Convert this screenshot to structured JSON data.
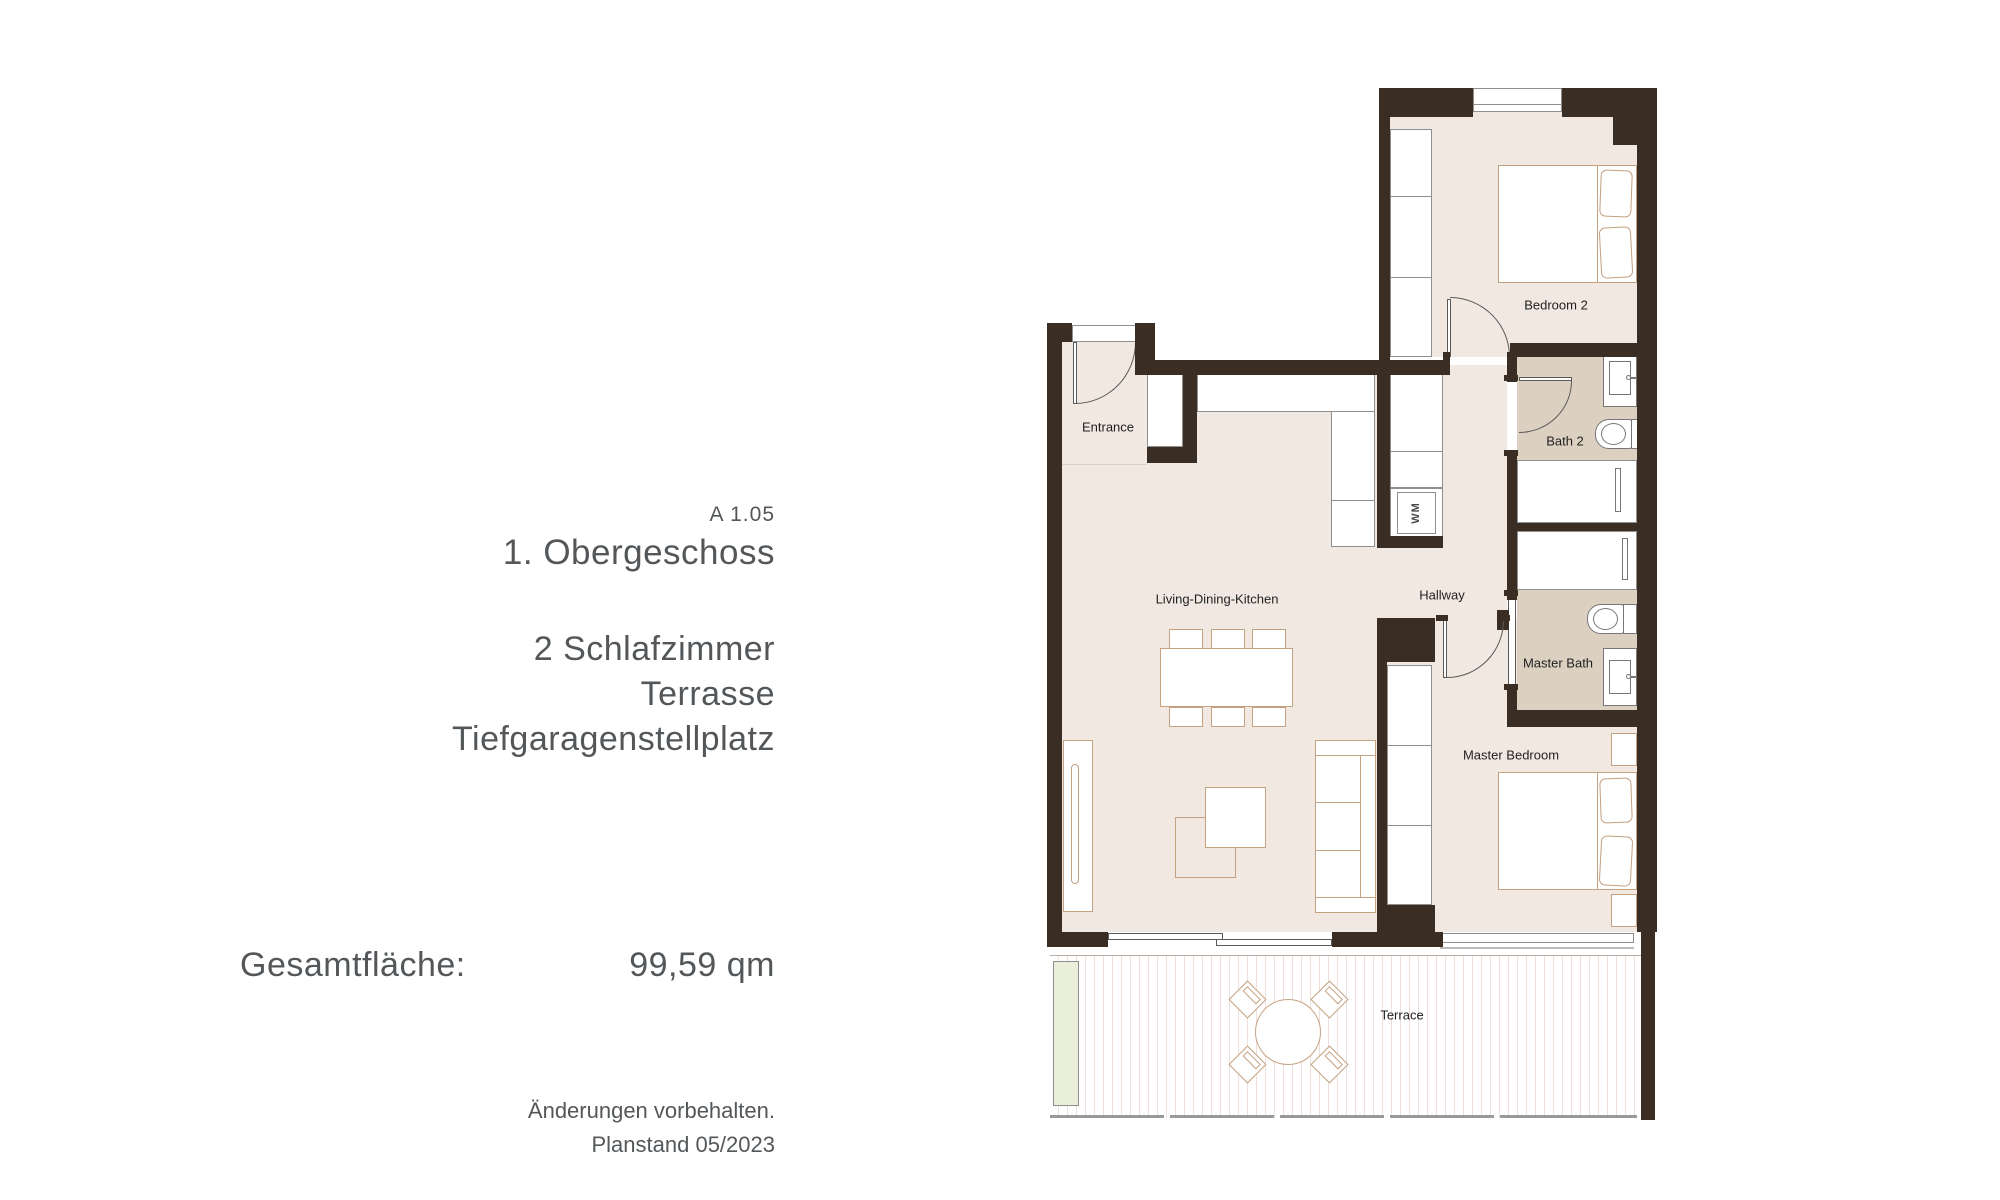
{
  "info_panel": {
    "unit_code": "A 1.05",
    "floor_title": "1. Obergeschoss",
    "features": [
      "2 Schlafzimmer",
      "Terrasse",
      "Tiefgaragenstellplatz"
    ],
    "area_label": "Gesamtfläche:",
    "area_value": "99,59 qm",
    "notes": [
      "Änderungen vorbehalten.",
      "Planstand 05/2023"
    ]
  },
  "floorplan": {
    "rooms": {
      "entrance": "Entrance",
      "living": "Living-Dining-Kitchen",
      "hallway": "Hallway",
      "bedroom2": "Bedroom 2",
      "bath2": "Bath 2",
      "master_bath": "Master Bath",
      "master_bedroom": "Master Bedroom",
      "terrace": "Terrace",
      "washing_machine": "WM"
    },
    "colors": {
      "wall": "#3a2e24",
      "floor": "#f1e9e1",
      "floor_bath": "#dcd0c1",
      "furniture_line": "#c3a181",
      "planter": "#e9efd9",
      "gray_line": "#8f8f8f",
      "text": "#53575a"
    }
  }
}
